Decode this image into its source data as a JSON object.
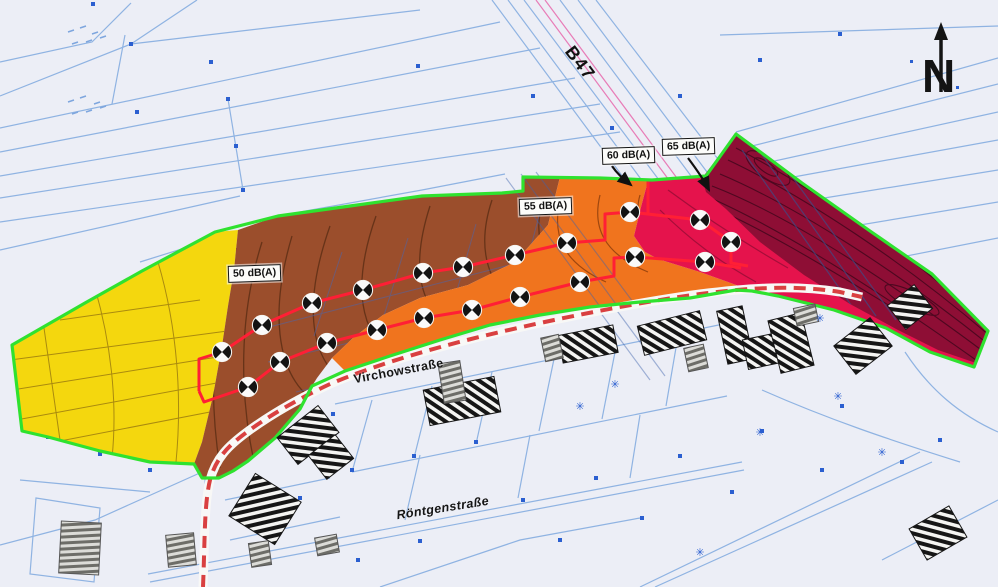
{
  "labels": {
    "b47": "B47",
    "virchowstrasse": "Virchowstraße",
    "roentgenstrasse": "Röntgenstraße",
    "north_arrow": "N"
  },
  "contour_labels": [
    "50 dB(A)",
    "55 dB(A)",
    "60 dB(A)",
    "65 dB(A)"
  ],
  "zone_colors": {
    "under_50": "#f4d70e",
    "db_50_55": "#9b4e2c",
    "db_55_60": "#f0741e",
    "db_60_65": "#e5134c",
    "over_65": "#7a0e31"
  },
  "colors": {
    "site_boundary_green": "#2fe22f",
    "measurement_line_red": "#ff1f35",
    "road_dash_red": "#d94040",
    "road_fill_white": "#f8f8f6",
    "cadastral_line_blue": "#8fb3e2",
    "cadastral_point_blue": "#2b5fd0",
    "b47_center_pink": "#e87cb7",
    "contour_line_dark": "#5e2f16",
    "paper_background": "#eceef6"
  },
  "markers": {
    "symbol": "crossed-circle-survey-point",
    "points": [
      [
        222,
        352
      ],
      [
        262,
        325
      ],
      [
        312,
        303
      ],
      [
        363,
        290
      ],
      [
        423,
        273
      ],
      [
        463,
        267
      ],
      [
        515,
        255
      ],
      [
        567,
        243
      ],
      [
        630,
        212
      ],
      [
        700,
        220
      ],
      [
        731,
        242
      ],
      [
        248,
        387
      ],
      [
        280,
        362
      ],
      [
        327,
        343
      ],
      [
        377,
        330
      ],
      [
        424,
        318
      ],
      [
        472,
        310
      ],
      [
        520,
        297
      ],
      [
        580,
        282
      ],
      [
        635,
        257
      ],
      [
        705,
        262
      ]
    ]
  },
  "icons": {
    "tree": "✳",
    "north_arrow_glyph": "↑"
  }
}
